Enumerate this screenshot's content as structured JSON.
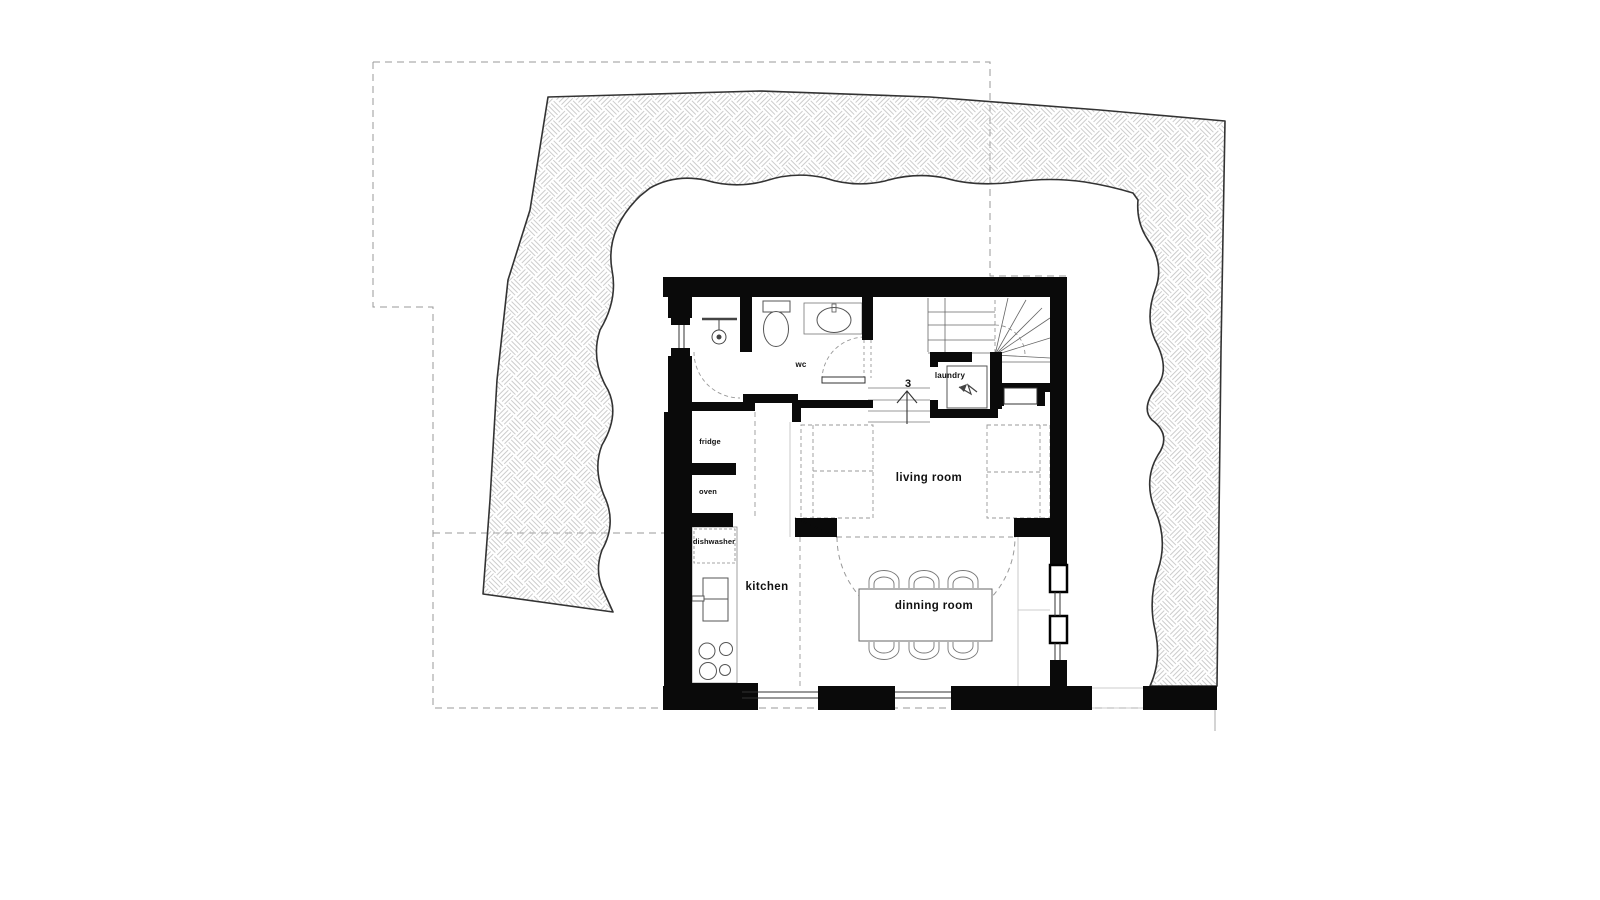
{
  "plan": {
    "type": "architectural-floor-plan",
    "rooms": {
      "wc": "wc",
      "laundry": "laundry",
      "kitchen": "kitchen",
      "living_room": "living room",
      "dining_room": "dinning room"
    },
    "appliances": {
      "fridge": "fridge",
      "oven": "oven",
      "dishwasher": "dishwasher"
    },
    "stairs": {
      "step_label": "3"
    },
    "colors": {
      "wall": "#0a0a0a",
      "terrain_outline": "#333333",
      "hatch_line": "#c6c6c6",
      "dash_line": "#999999",
      "fixture_line": "#555555",
      "background": "#ffffff"
    }
  }
}
